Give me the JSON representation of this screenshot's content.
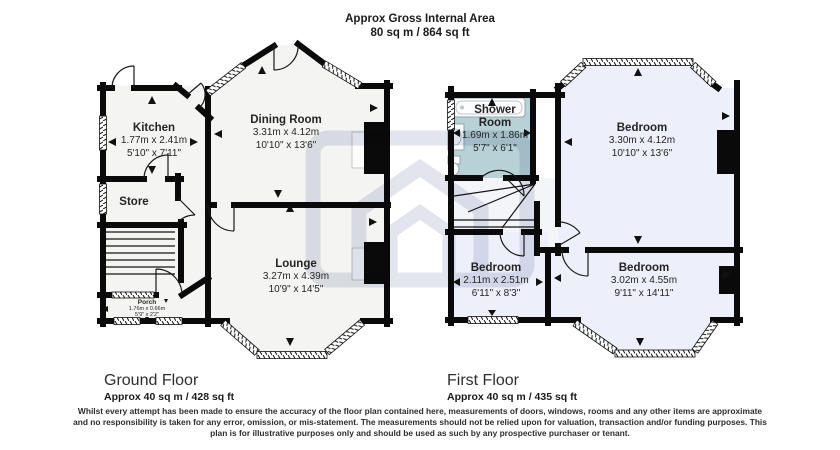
{
  "header": {
    "line1": "Approx Gross Internal Area",
    "line2": "80 sq m / 864 sq ft"
  },
  "ground_floor": {
    "title": "Ground Floor",
    "area": "Approx 40 sq m / 428 sq ft",
    "rooms": {
      "kitchen": {
        "name": "Kitchen",
        "metric": "1.77m x 2.41m",
        "imperial": "5'10\" x 7'11\""
      },
      "dining": {
        "name": "Dining Room",
        "metric": "3.31m x 4.12m",
        "imperial": "10'10\" x 13'6\""
      },
      "store": {
        "name": "Store"
      },
      "lounge": {
        "name": "Lounge",
        "metric": "3.27m x 4.39m",
        "imperial": "10'9\" x 14'5\""
      },
      "porch": {
        "name": "Porch",
        "metric": "1.76m x 0.66m",
        "imperial": "5'9\" x 2'2\""
      }
    }
  },
  "first_floor": {
    "title": "First Floor",
    "area": "Approx 40 sq m / 435 sq ft",
    "rooms": {
      "shower": {
        "name": "Shower Room",
        "metric": "1.69m x 1.86m",
        "imperial": "5'7\" x 6'1\""
      },
      "bedroom_rear": {
        "name": "Bedroom",
        "metric": "3.30m x 4.12m",
        "imperial": "10'10\" x 13'6\""
      },
      "bedroom_middle": {
        "name": "Bedroom",
        "metric": "2.11m x 2.51m",
        "imperial": "6'11\" x 8'3\""
      },
      "bedroom_front": {
        "name": "Bedroom",
        "metric": "3.02m x 4.55m",
        "imperial": "9'11\" x 14'11\""
      }
    }
  },
  "disclaimer": "Whilst every attempt has been made to ensure the accuracy of the floor plan contained here, measurements of doors, windows, rooms and any other items are approximate and no responsibility is taken for any error, omission, or mis-statement. The measurements should not be relied upon for valuation, transaction and/or funding purposes. This plan is for illustrative purposes only and should be used as such by any prospective purchaser or tenant.",
  "colors": {
    "wall": "#0a0a0a",
    "ground_room_fill": "#f4f4f2",
    "bedroom_fill": "#edf0fa",
    "landing_fill": "#f4f5f9",
    "shower_fill": "#b7d2d6",
    "watermark": "#e2e4ee"
  }
}
